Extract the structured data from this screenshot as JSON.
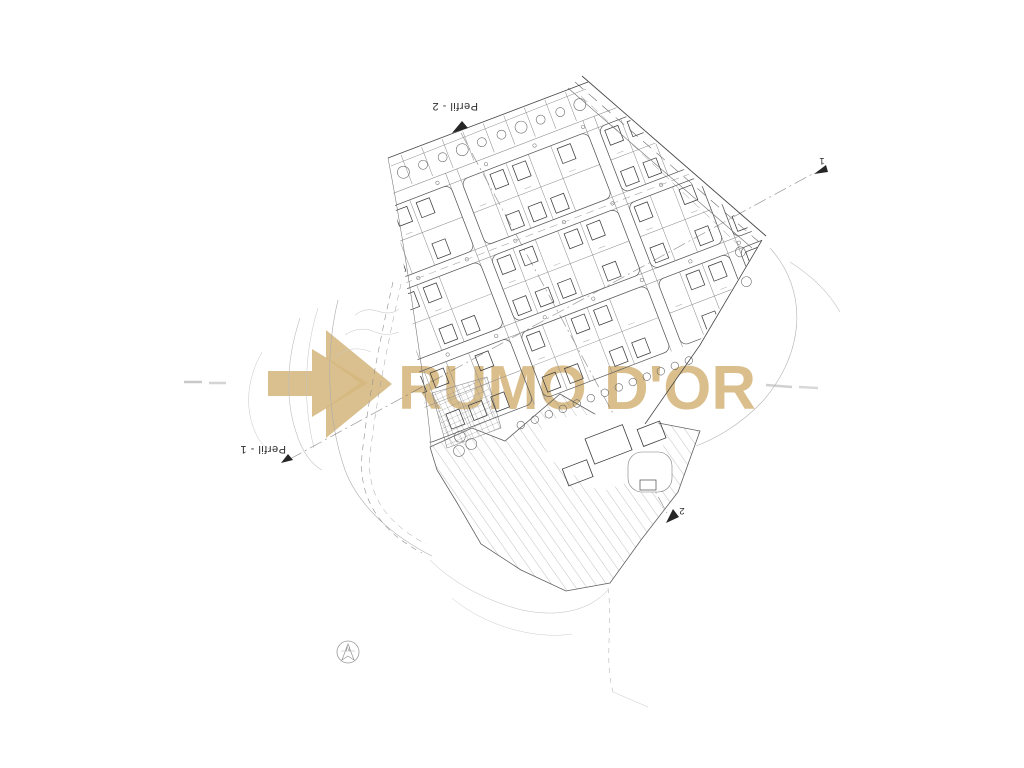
{
  "watermark": {
    "text": "RUMO D'OR"
  },
  "labels": {
    "perfil_2": "Perfil - 2",
    "perfil_1": "Perfil - 1",
    "section_marker_1": "1",
    "section_marker_2": "2"
  },
  "compass": {
    "label": "N"
  },
  "colors": {
    "background": "#ffffff",
    "watermark_gold": "#d5b77e",
    "line_dark": "#3f3f3f",
    "line_mid": "#6f6f6f",
    "line_light": "#9a9a9a"
  }
}
